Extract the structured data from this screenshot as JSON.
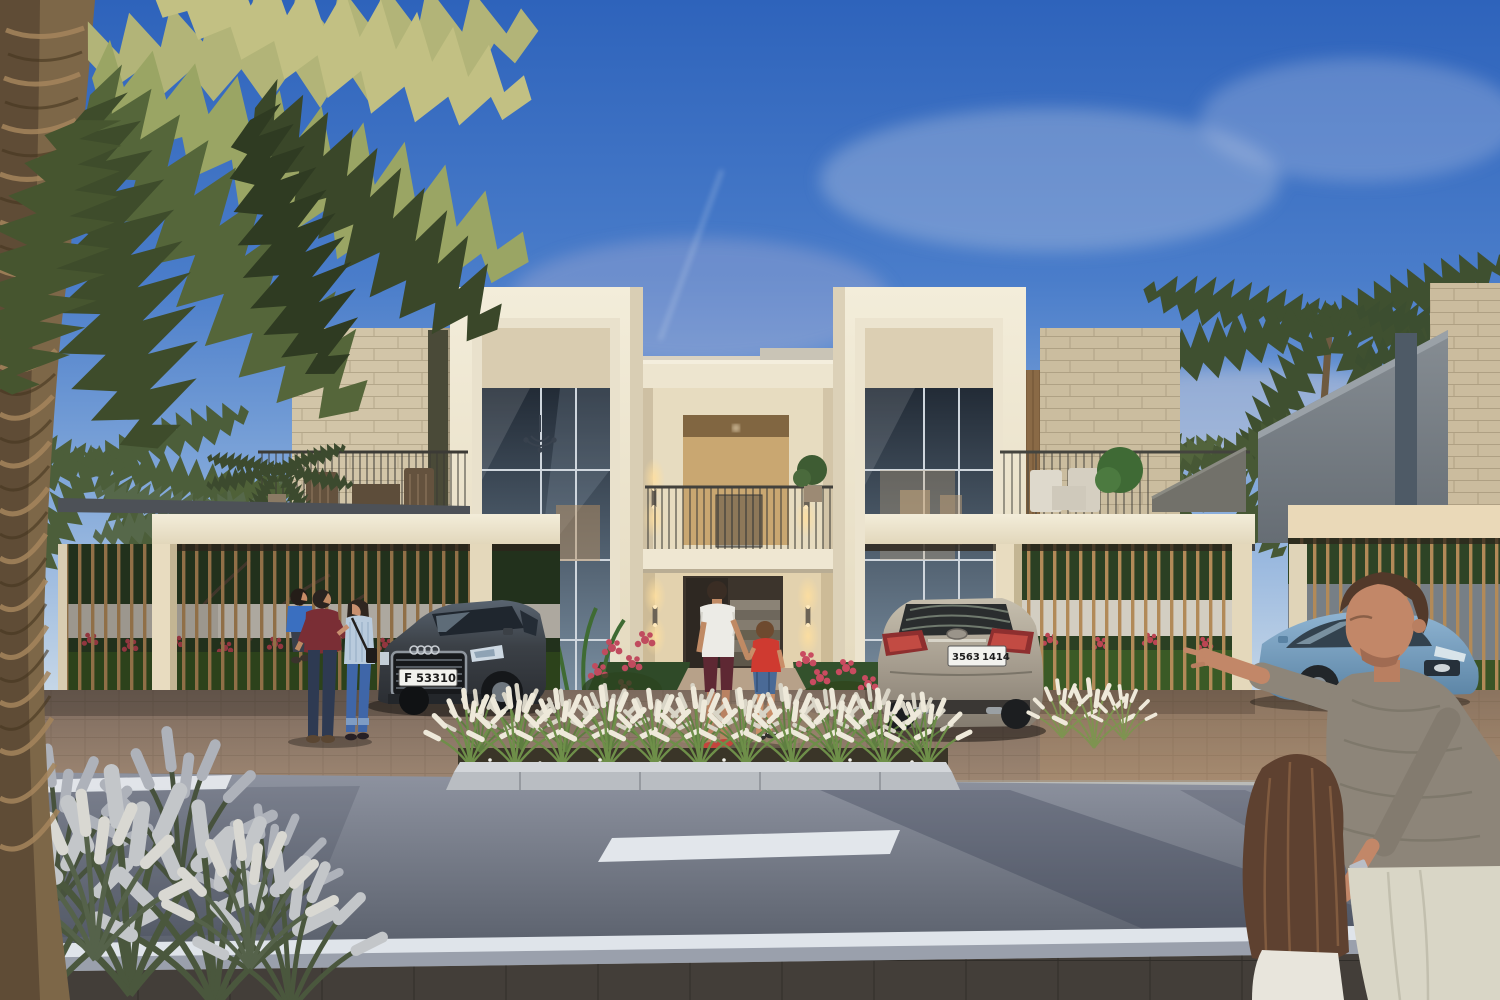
{
  "scene": {
    "title": "Townhouse exterior rendering at dusk",
    "labels": {
      "sky": "Blue sky with wispy clouds",
      "palm": "Date palm tree",
      "building": "Two-storey cream townhouse",
      "entrance": "Recessed entrance with stairs and sconces",
      "left_terrace": "Left terrace with wooden furniture",
      "right_terrace": "Right terrace with white furniture",
      "left_carport": "Left slatted carport",
      "right_carport": "Right slatted carport",
      "neighbor_carport": "Neighbouring carport",
      "left_car": "Dark grey sedan",
      "right_car": "Silver sedan",
      "blue_car": "Light blue sedan",
      "family_left": "Couple with toddler",
      "father_son": "Father and son walking to entrance",
      "father_daughter": "Father pointing, holding daughter's hand",
      "planter": "Ornamental grass planter island",
      "road": "Asphalt road with lane markings",
      "sidewalk": "Paved sidewalk",
      "garden": "Garden with red flowers behind slats"
    }
  },
  "plates": {
    "left": {
      "prefix": "F",
      "number": "53310"
    },
    "right": {
      "left": "3563",
      "right": "1414"
    }
  },
  "palette": {
    "sky_top": "#2e63bb",
    "sky_horizon": "#d7e2ec",
    "wall_cream": "#ece2c9",
    "stone": "#cfc2a6",
    "wood_slat": "#b28a58",
    "asphalt": "#646a76",
    "lane_marking": "#e8ecf0",
    "grass_plume": "#e7e3d7",
    "foliage": "#33501f",
    "flower_red": "#c04b5e",
    "left_car_body": "#3b4046",
    "right_car_body": "#a39a8c",
    "blue_car_body": "#7ca6c6"
  }
}
